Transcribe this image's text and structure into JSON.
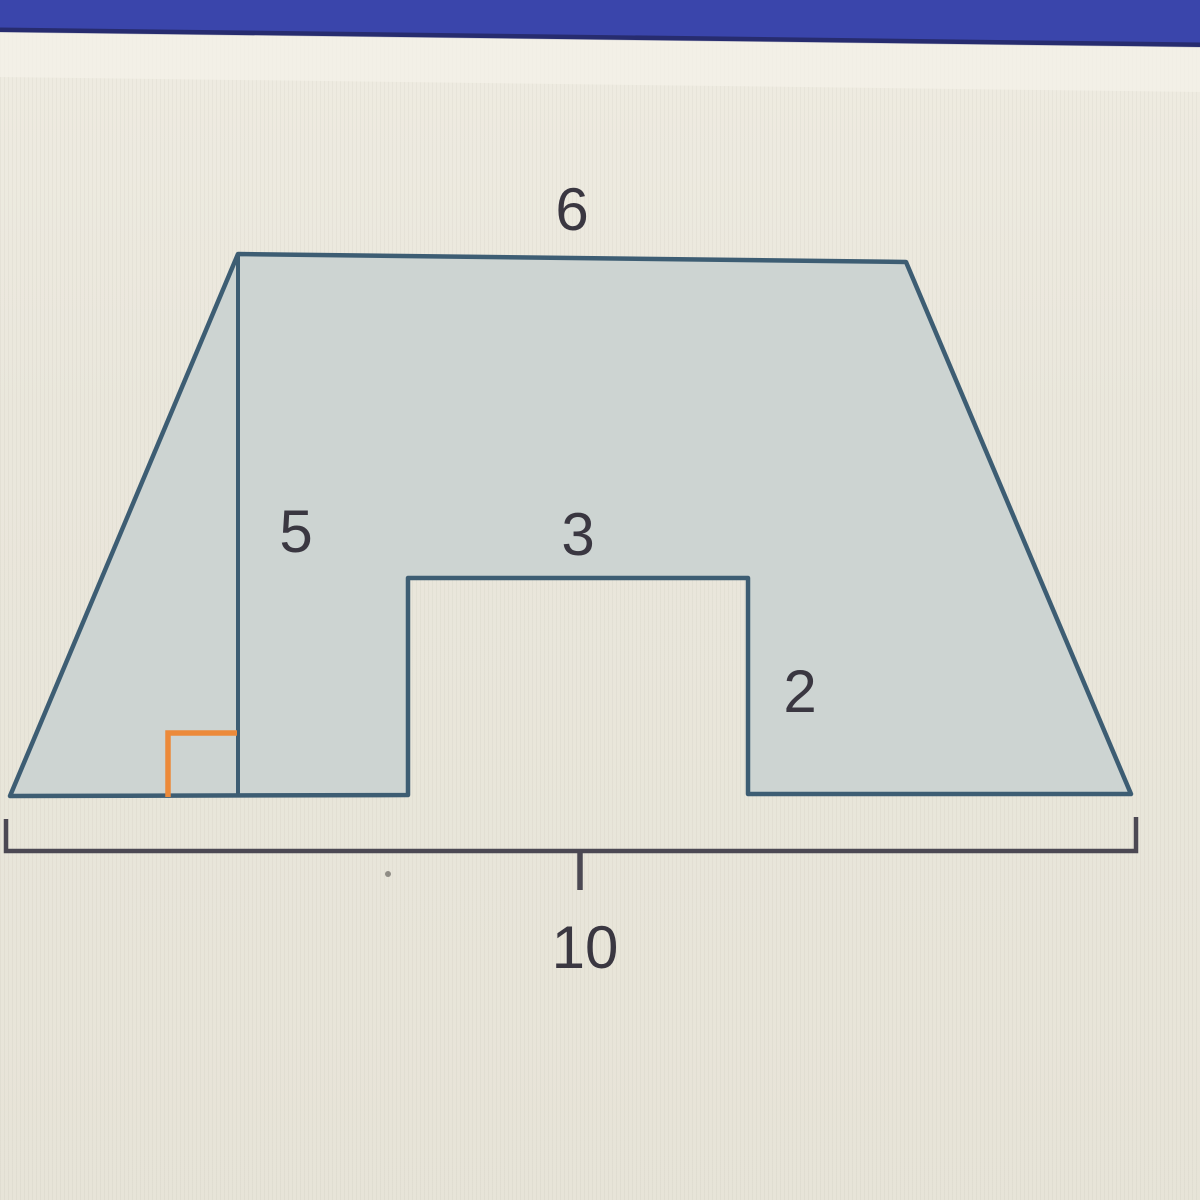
{
  "figure": {
    "description": "trapezoid with rectangular notch cut from bottom edge",
    "colors": {
      "top_banner": "#3a45ab",
      "top_banner_edge": "#272c6f",
      "background": "#e9e6db",
      "shape_fill": "#cdd4d2",
      "shape_outline": "#3d5d73",
      "right_angle_marker": "#ec8a3a",
      "bracket": "#4b4853",
      "label_text": "#3a3741"
    },
    "labels": {
      "top_side": "6",
      "height": "5",
      "notch_width": "3",
      "notch_height": "2",
      "base": "10"
    }
  }
}
